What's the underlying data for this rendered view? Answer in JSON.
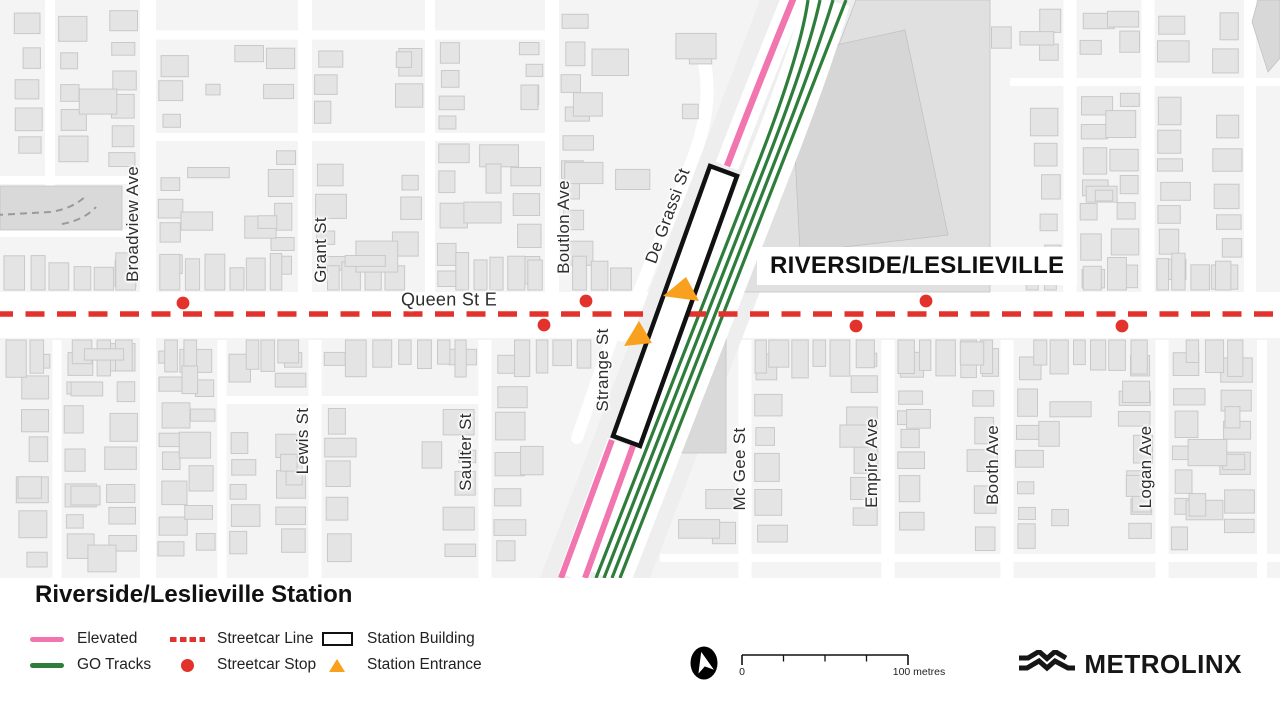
{
  "map": {
    "area_label": "RIVERSIDE/LESLIEVILLE",
    "street_labels": [
      {
        "text": "Broadview Ave"
      },
      {
        "text": "Grant St"
      },
      {
        "text": "Boutlon Ave"
      },
      {
        "text": "De Grassi St"
      },
      {
        "text": "Queen St E"
      },
      {
        "text": "Strange St"
      },
      {
        "text": "Lewis St"
      },
      {
        "text": "Saulter St"
      },
      {
        "text": "Mc Gee St"
      },
      {
        "text": "Empire Ave"
      },
      {
        "text": "Booth Ave"
      },
      {
        "text": "Logan Ave"
      }
    ],
    "colors": {
      "map_bg": "#f4f4f4",
      "street": "#ffffff",
      "corridor": "#eeeeee",
      "dark_block": "#e0e0e0",
      "darker_block": "#d6d6d6",
      "building_fill": "#e4e4e4",
      "building_stroke": "#c9c9c9",
      "elevated": "#F175AE",
      "go": "#2E7D3B",
      "streetcar": "#E2322B",
      "entrance": "#F9A01E",
      "station_outline": "#111111"
    },
    "geometry": {
      "queen_band": [
        292,
        338
      ],
      "streetcar_line_y": 314,
      "verticals": [
        [
          50,
          0,
          186,
          10
        ],
        [
          148,
          0,
          578,
          16
        ],
        [
          305,
          0,
          292,
          14
        ],
        [
          430,
          0,
          292,
          10
        ],
        [
          552,
          0,
          292,
          14
        ],
        [
          1070,
          0,
          292,
          13
        ],
        [
          1148,
          0,
          292,
          13
        ],
        [
          1250,
          0,
          292,
          12
        ],
        [
          57,
          340,
          578,
          9
        ],
        [
          222,
          340,
          578,
          9
        ],
        [
          315,
          340,
          578,
          13
        ],
        [
          485,
          340,
          578,
          13
        ],
        [
          745,
          340,
          578,
          13
        ],
        [
          888,
          340,
          578,
          13
        ],
        [
          1007,
          340,
          578,
          13
        ],
        [
          1162,
          340,
          578,
          13
        ],
        [
          1262,
          340,
          578,
          10
        ]
      ],
      "lanes": [
        [
          35,
          148,
          552,
          9
        ],
        [
          137,
          148,
          552,
          8
        ],
        [
          180,
          0,
          148,
          8
        ],
        [
          233,
          0,
          148,
          8
        ],
        [
          82,
          1010,
          1280,
          8
        ],
        [
          400,
          222,
          485,
          8
        ],
        [
          558,
          660,
          1280,
          8
        ]
      ],
      "diagonals": [
        {
          "d": "M 703,55 C 712,95 706,128 688,172 L 622,335",
          "w": 13
        },
        {
          "d": "M 612,338 L 577,438",
          "w": 12
        }
      ],
      "corridor_band": [
        [
          760,
          0
        ],
        [
          872,
          0
        ],
        [
          650,
          578
        ],
        [
          540,
          578
        ]
      ],
      "dark_blocks": [
        {
          "pts": [
            [
              856,
              0
            ],
            [
              990,
              0
            ],
            [
              990,
              292
            ],
            [
              744,
              292
            ]
          ],
          "fill": "#e0e0e0"
        },
        {
          "pts": [
            [
              790,
              55
            ],
            [
              905,
              30
            ],
            [
              948,
              235
            ],
            [
              800,
              252
            ]
          ],
          "fill": "#d6d6d6"
        },
        {
          "pts": [
            [
              0,
              186
            ],
            [
              122,
              186
            ],
            [
              122,
              230
            ],
            [
              0,
              230
            ]
          ],
          "fill": "#d9d9d9"
        },
        {
          "pts": [
            [
              714,
              338
            ],
            [
              726,
              338
            ],
            [
              726,
              453
            ],
            [
              665,
              453
            ]
          ],
          "fill": "#d9d9d9"
        },
        {
          "pts": [
            [
              1258,
              0
            ],
            [
              1280,
              0
            ],
            [
              1280,
              58
            ],
            [
              1268,
              72
            ],
            [
              1252,
              22
            ]
          ],
          "fill": "#d8d8d8"
        }
      ],
      "spur_paths": [
        "M -4,215 L 50,212 Q 72,209 86,196",
        "M 62,224 Q 84,220 96,207"
      ],
      "go_tracks": [
        [
          596,
          808
        ],
        [
          604,
          820
        ],
        [
          612,
          833
        ],
        [
          620,
          846
        ]
      ],
      "track_white_band": [
        608,
        827
      ],
      "elevated_upper": "M 727,166 Q 760,80 796,-8",
      "elevated_lower": [
        [
          612,
          440,
          561,
          578
        ],
        [
          633,
          446,
          585,
          578
        ]
      ],
      "elevated_lower_white": [
        622,
        443,
        573,
        578
      ],
      "station_building": [
        [
          710,
          166
        ],
        [
          737,
          176
        ],
        [
          640,
          446
        ],
        [
          613,
          436
        ]
      ],
      "entrances": [
        [
          [
            663,
            296
          ],
          [
            686,
            277
          ],
          [
            699,
            301
          ]
        ],
        [
          [
            624,
            346
          ],
          [
            639,
            321
          ],
          [
            652,
            343
          ]
        ]
      ],
      "stops": [
        [
          183,
          303
        ],
        [
          586,
          301
        ],
        [
          544,
          325
        ],
        [
          926,
          301
        ],
        [
          856,
          326
        ],
        [
          1122,
          326
        ]
      ],
      "exclusion_rects": [
        [
          745,
          0,
          245,
          292
        ],
        [
          0,
          186,
          122,
          46
        ],
        [
          660,
          338,
          84,
          132
        ],
        [
          750,
          243,
          272,
          50
        ],
        [
          1240,
          0,
          40,
          80
        ]
      ],
      "corridor_zone": {
        "left_top": 790,
        "left_slope": 0.392,
        "left_pad": 44,
        "right_top": 848,
        "right_slope": 0.391,
        "right_pad": 16
      }
    }
  },
  "legend": {
    "title": "Riverside/Leslieville Station",
    "items": [
      {
        "label": "Elevated",
        "type": "line",
        "color": "#F175AE"
      },
      {
        "label": "GO Tracks",
        "type": "line",
        "color": "#2E7D3B"
      },
      {
        "label": "Streetcar Line",
        "type": "dash",
        "color": "#E2322B"
      },
      {
        "label": "Streetcar Stop",
        "type": "dot",
        "color": "#E2322B"
      },
      {
        "label": "Station Building",
        "type": "rect",
        "color": "#111111"
      },
      {
        "label": "Station Entrance",
        "type": "tri",
        "color": "#F9A01E"
      }
    ]
  },
  "scale_bar": {
    "start_label": "0",
    "end_label": "100 metres"
  },
  "logo": {
    "text": "METROLINX"
  }
}
